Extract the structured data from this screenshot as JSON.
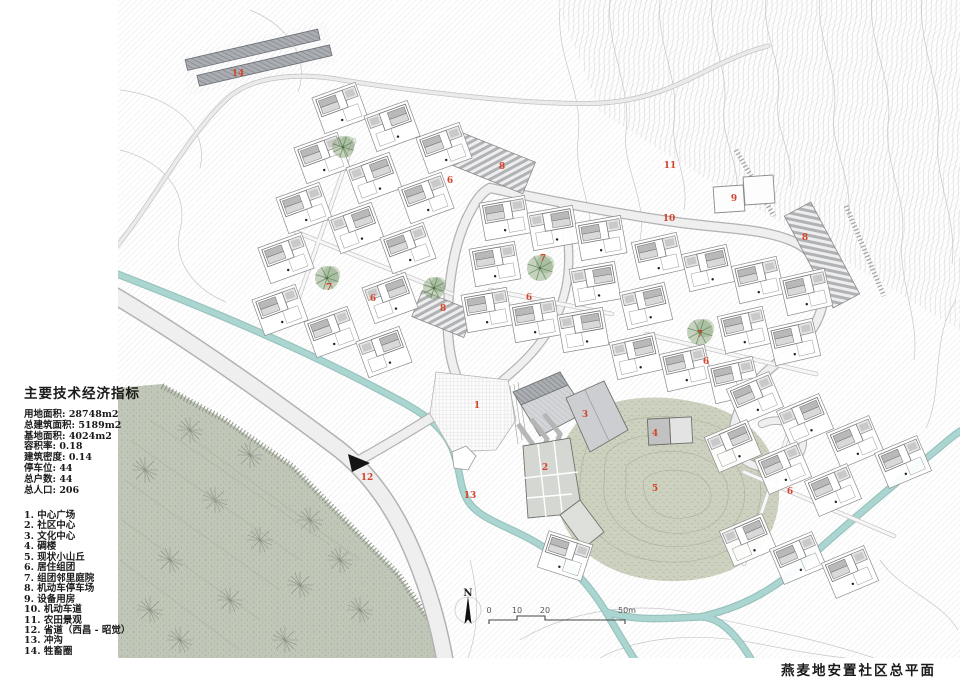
{
  "title": "燕麦地安置社区总平面",
  "panel": {
    "indicators_title": "主要技术经济指标",
    "indicators": [
      "用地面积: 28748m2",
      "总建筑面积: 5189m2",
      "基地面积: 4024m2",
      "容积率: 0.18",
      "建筑密度: 0.14",
      "停车位: 44",
      "总户数: 44",
      "总人口: 206"
    ],
    "legend": [
      "1. 中心广场",
      "2. 社区中心",
      "3. 文化中心",
      "4. 碉楼",
      "5. 现状小山丘",
      "6. 居住组团",
      "7. 组团邻里庭院",
      "8. 机动车停车场",
      "9. 设备用房",
      "10. 机动车道",
      "11. 农田景观",
      "12. 省道（西昌 - 昭觉）",
      "13. 冲沟",
      "14. 牲畜圈"
    ]
  },
  "compass": {
    "north_label": "N"
  },
  "scalebar": {
    "labels": [
      {
        "t": "0",
        "x": 489
      },
      {
        "t": "10",
        "x": 517
      },
      {
        "t": "20",
        "x": 545
      },
      {
        "t": "50m",
        "x": 627
      }
    ]
  },
  "colors": {
    "label_red": "#d2452c",
    "stream": "#abd5d0",
    "road_fill": "#efefef",
    "farmland": "#bdc4b4",
    "hill": "#c9cdbb",
    "tree": "#7f9e72"
  },
  "map": {
    "area_labels": [
      {
        "n": "1",
        "x": 477,
        "y": 408
      },
      {
        "n": "2",
        "x": 545,
        "y": 470
      },
      {
        "n": "3",
        "x": 585,
        "y": 417
      },
      {
        "n": "4",
        "x": 655,
        "y": 436
      },
      {
        "n": "5",
        "x": 655,
        "y": 491
      },
      {
        "n": "6",
        "x": 450,
        "y": 183
      },
      {
        "n": "6",
        "x": 373,
        "y": 301
      },
      {
        "n": "6",
        "x": 529,
        "y": 300
      },
      {
        "n": "6",
        "x": 706,
        "y": 364
      },
      {
        "n": "6",
        "x": 790,
        "y": 494
      },
      {
        "n": "7",
        "x": 329,
        "y": 290
      },
      {
        "n": "7",
        "x": 543,
        "y": 261
      },
      {
        "n": "7",
        "x": 700,
        "y": 337
      },
      {
        "n": "8",
        "x": 502,
        "y": 169
      },
      {
        "n": "8",
        "x": 443,
        "y": 311
      },
      {
        "n": "8",
        "x": 805,
        "y": 240
      },
      {
        "n": "9",
        "x": 734,
        "y": 201
      },
      {
        "n": "10",
        "x": 669,
        "y": 221
      },
      {
        "n": "11",
        "x": 670,
        "y": 168
      },
      {
        "n": "12",
        "x": 367,
        "y": 480
      },
      {
        "n": "13",
        "x": 470,
        "y": 498
      },
      {
        "n": "14",
        "x": 238,
        "y": 76
      }
    ],
    "house_clusters": [
      {
        "name": "cluster-northwest",
        "rot": -20,
        "pts": [
          [
            340,
            108
          ],
          [
            392,
            126
          ],
          [
            444,
            148
          ],
          [
            322,
            158
          ],
          [
            374,
            178
          ],
          [
            426,
            198
          ],
          [
            304,
            208
          ],
          [
            356,
            228
          ],
          [
            408,
            248
          ],
          [
            286,
            258
          ],
          [
            390,
            298
          ],
          [
            280,
            310
          ],
          [
            332,
            332
          ],
          [
            384,
            352
          ]
        ]
      },
      {
        "name": "cluster-middle",
        "rot": -10,
        "pts": [
          [
            505,
            218
          ],
          [
            553,
            228
          ],
          [
            601,
            238
          ],
          [
            495,
            264
          ],
          [
            595,
            284
          ],
          [
            487,
            310
          ],
          [
            535,
            320
          ],
          [
            583,
            330
          ]
        ]
      },
      {
        "name": "cluster-east",
        "rot": -13,
        "pts": [
          [
            658,
            256
          ],
          [
            708,
            268
          ],
          [
            758,
            280
          ],
          [
            806,
            292
          ],
          [
            646,
            306
          ],
          [
            744,
            330
          ],
          [
            794,
            342
          ],
          [
            636,
            356
          ],
          [
            686,
            368
          ],
          [
            734,
            380
          ]
        ]
      },
      {
        "name": "cluster-southeast",
        "rot": -23,
        "pts": [
          [
            755,
            398
          ],
          [
            805,
            420
          ],
          [
            855,
            442
          ],
          [
            903,
            462
          ],
          [
            733,
            446
          ],
          [
            783,
            468
          ],
          [
            833,
            490
          ],
          [
            748,
            540
          ],
          [
            798,
            558
          ],
          [
            850,
            572
          ]
        ]
      },
      {
        "name": "cluster-south",
        "rot": 18,
        "pts": [
          [
            565,
            556
          ]
        ]
      }
    ],
    "trees": [
      {
        "x": 343,
        "y": 147,
        "r": 11
      },
      {
        "x": 327,
        "y": 278,
        "r": 12
      },
      {
        "x": 434,
        "y": 288,
        "r": 11
      },
      {
        "x": 540,
        "y": 268,
        "r": 13
      },
      {
        "x": 700,
        "y": 332,
        "r": 13
      }
    ]
  }
}
